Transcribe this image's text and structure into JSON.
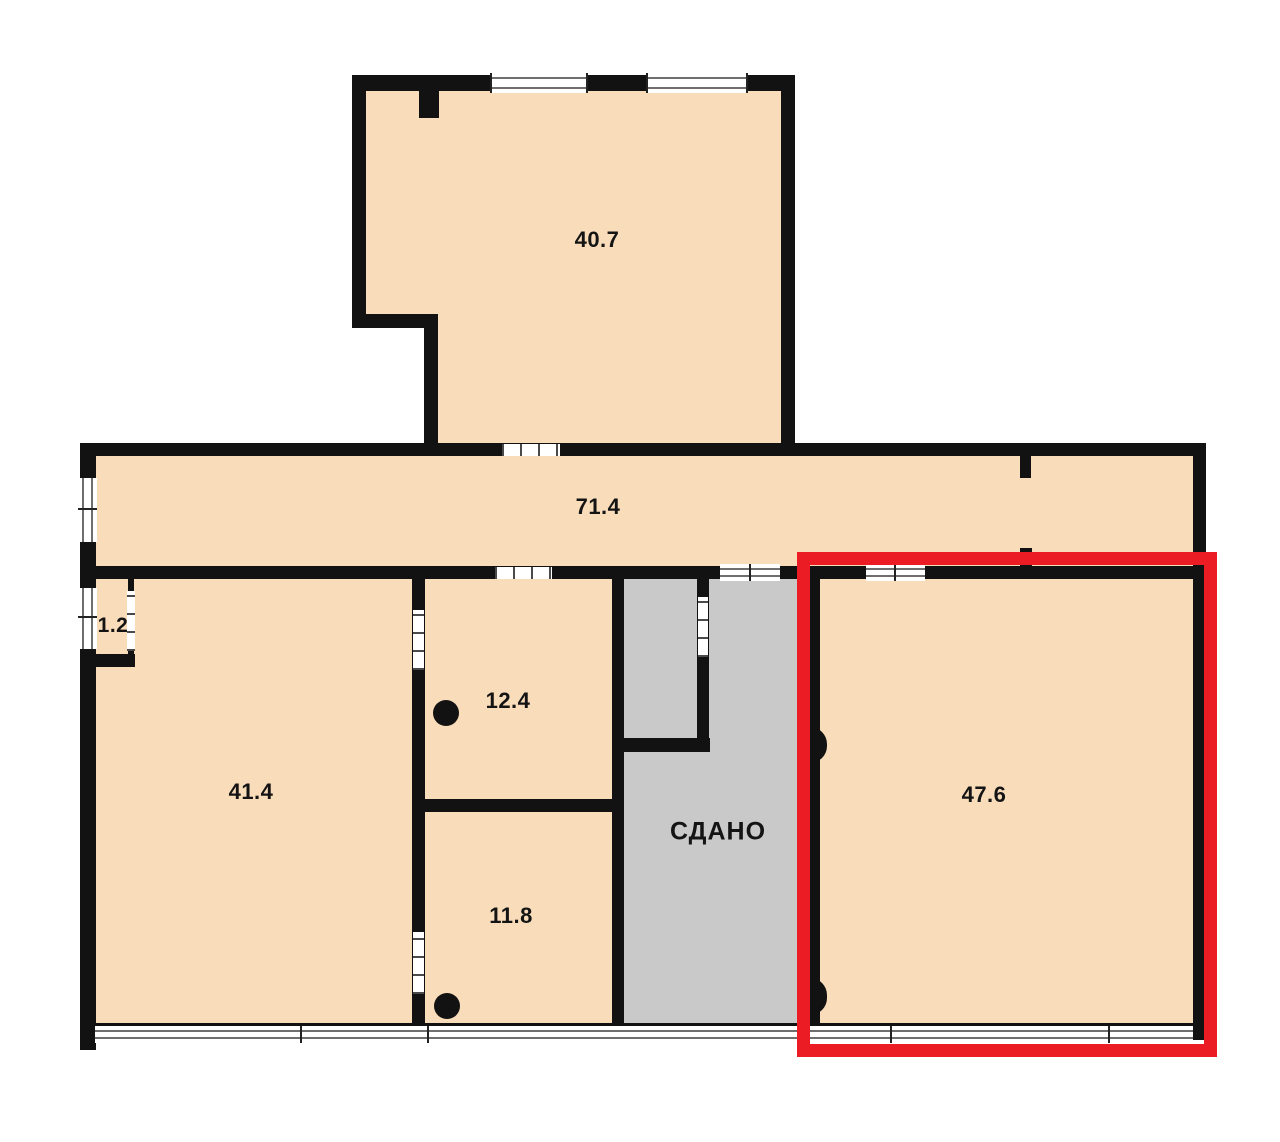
{
  "plan": {
    "kind": "apartment-floor-plan",
    "highlighted_room_label": "47.6",
    "rented_area_label": "СДАНО"
  },
  "rooms": [
    {
      "id": "room-40-7",
      "label": "40.7"
    },
    {
      "id": "room-71-4",
      "label": "71.4"
    },
    {
      "id": "room-1-2",
      "label": "1.2"
    },
    {
      "id": "room-41-4",
      "label": "41.4"
    },
    {
      "id": "room-12-4",
      "label": "12.4"
    },
    {
      "id": "room-11-8",
      "label": "11.8"
    },
    {
      "id": "room-rented",
      "label": "СДАНО"
    },
    {
      "id": "room-47-6",
      "label": "47.6"
    }
  ],
  "colors": {
    "room_fill": "#F9DCBA",
    "rented_fill": "#C9C9C9",
    "wall": "#121212",
    "highlight_border": "#EC1C24",
    "background": "#FFFFFF",
    "window_fill": "#FFFFFF",
    "window_line": "#6E6E6E",
    "label_text": "#141414"
  }
}
